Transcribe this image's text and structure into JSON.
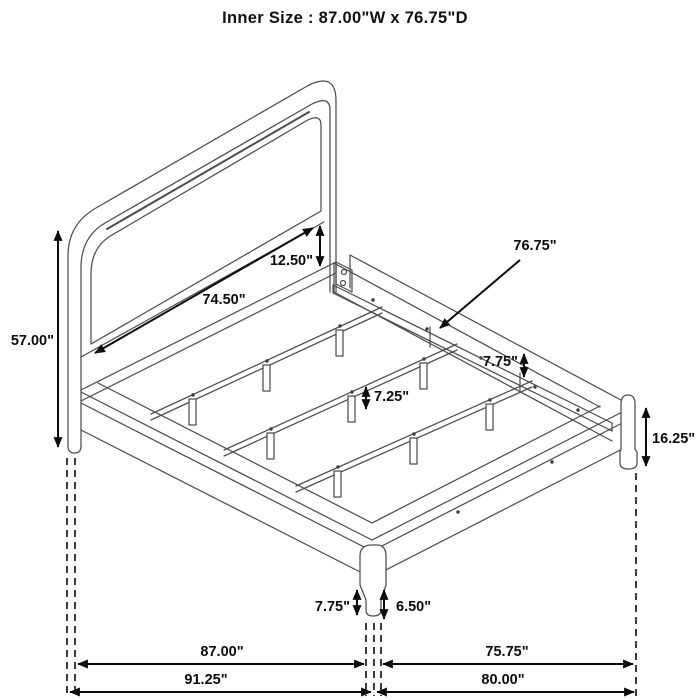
{
  "title": "Inner Size : 87.00\"W x 76.75\"D",
  "dims": {
    "overall_height": "57.00\"",
    "headboard_width": "74.50\"",
    "headboard_gap": "12.50\"",
    "rail_length": "76.75\"",
    "rail_drop": "7.75\"",
    "support_leg_height": "7.25\"",
    "footboard_height": "16.25\"",
    "front_leg_height": "7.75\"",
    "front_leg_lower": "6.50\"",
    "width_inner": "87.00\"",
    "depth_inner": "75.75\"",
    "width_outer": "91.25\"",
    "depth_outer": "80.00\""
  },
  "colors": {
    "ink": "#0c0c0c",
    "line_art": "#4d4d4d"
  }
}
